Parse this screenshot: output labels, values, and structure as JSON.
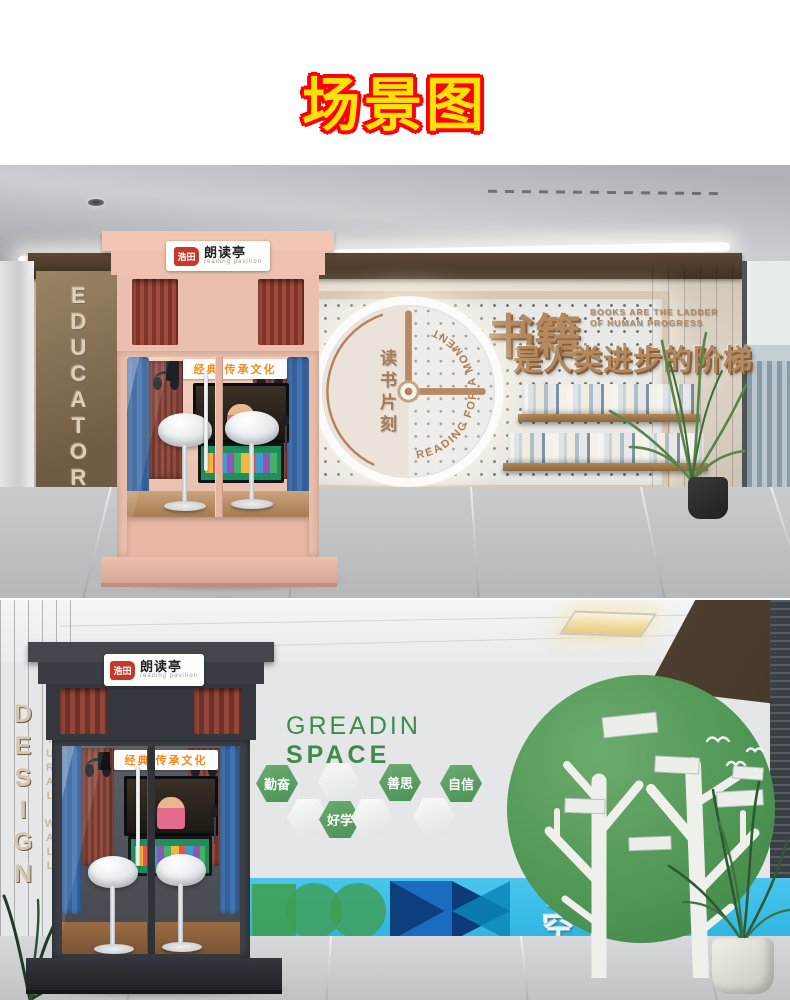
{
  "title": "场景图",
  "colors": {
    "title_fill": "#ffe10a",
    "title_outline": "#ff0000",
    "booth_pink": "#eec0ad",
    "booth_dark": "#3c4046",
    "bronze": "#b5895f",
    "accent_orange": "#f58a1d",
    "logo_red": "#c5392b",
    "accent_green": "#4f9d5b",
    "band_blue": "#3ec0ea",
    "curtain_blue": "#3e6ca6"
  },
  "booth": {
    "logo": "浩田",
    "name": "朗读亭",
    "subtitle": "reading pavilion",
    "banner": "经典 传承文化"
  },
  "scene_top": {
    "wall_vertical": "EDUCATORS",
    "clock": {
      "phrase_cn": "读书片刻",
      "phrase_en": "READING FOR A MOMENT"
    },
    "slogan": {
      "cn_main": "书籍",
      "en_line1": "BOOKS ARE THE LADDER",
      "en_line2": "OF HUMAN PROGRESS",
      "cn_sub": "是人类进步的阶梯"
    }
  },
  "scene_bottom": {
    "wall_line1": "CULTURAL WALL",
    "wall_line2": "DESIGN",
    "heading_line1": "GREADIN",
    "heading_line2": "SPACE",
    "hexagons": [
      "勤奋",
      "好学",
      "善思",
      "自信"
    ],
    "band_line1": "悦读",
    "band_line2": "空间"
  }
}
